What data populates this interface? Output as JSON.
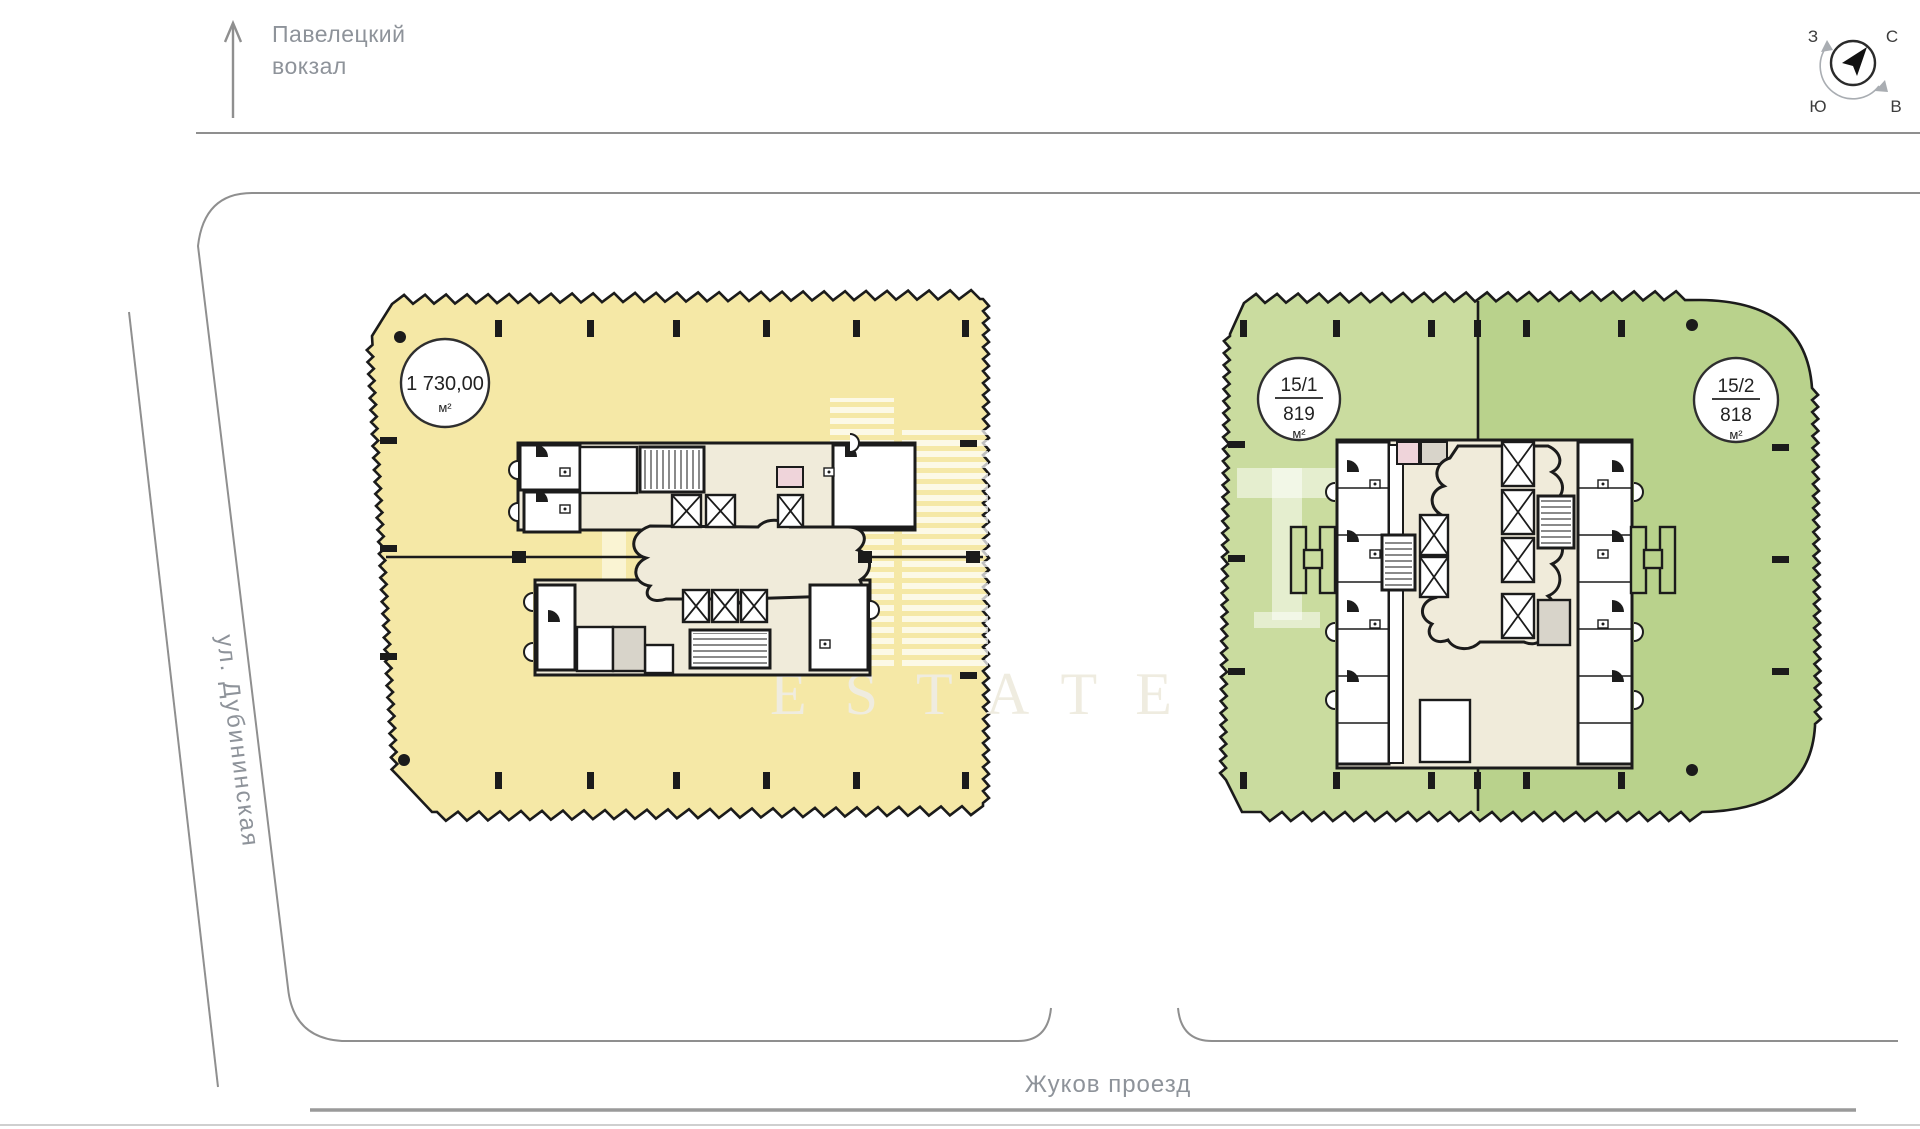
{
  "destination": {
    "line1": "Павелецкий",
    "line2": "вокзал"
  },
  "compass": {
    "north": "С",
    "east": "В",
    "south": "Ю",
    "west": "З"
  },
  "streets": {
    "left": "ул. Дубининская",
    "bottom": "Жуков проезд"
  },
  "plots": {
    "left": {
      "area": "1 730,00",
      "unit": "м²"
    },
    "right_a": {
      "number": "15/1",
      "area": "819",
      "unit": "м²"
    },
    "right_b": {
      "number": "15/2",
      "area": "818",
      "unit": "м²"
    }
  },
  "watermark": {
    "text": "ESTATE"
  },
  "colors": {
    "yellow": "#F5E8A6",
    "green_light": "#CADC9F",
    "green_dark": "#B9D28C",
    "core_cream": "#F0EBDA",
    "room_white": "#FFFFFF",
    "room_gray": "#D8D4CA",
    "room_pink": "#EFD4DA",
    "wall": "#1B1B1B",
    "street_line": "#8F8F8F",
    "label_gray": "#8E939A"
  }
}
